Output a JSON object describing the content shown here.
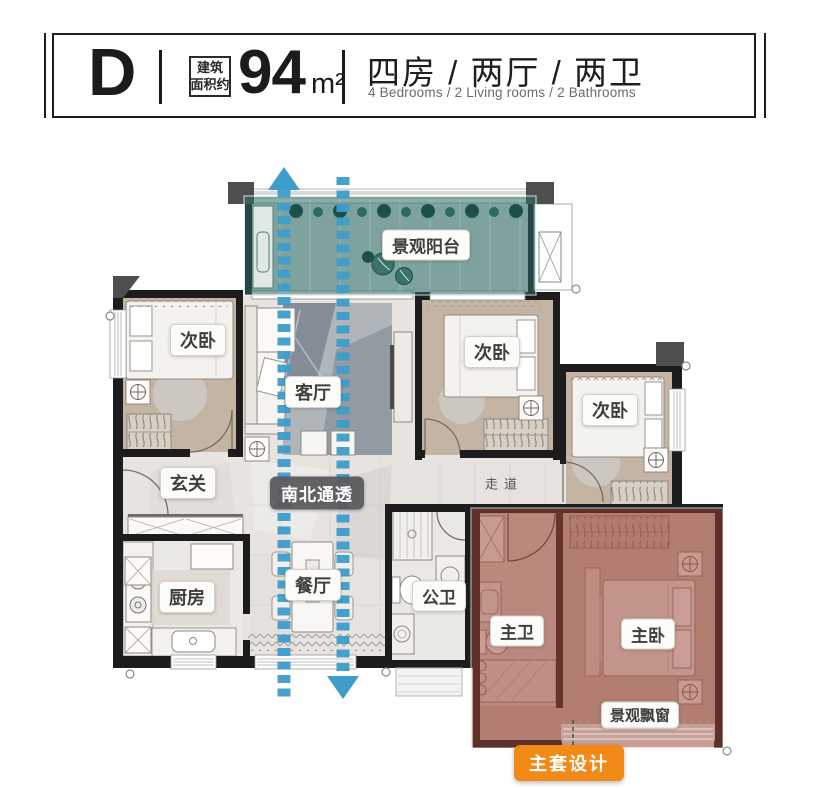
{
  "header": {
    "unit": "D",
    "area_label": [
      "建筑",
      "面积约"
    ],
    "area_value": "94",
    "area_unit": "m²",
    "layout_cn": "四房 / 两厅 / 两卫",
    "layout_en": "4 Bedrooms / 2 Living rooms / 2 Bathrooms"
  },
  "rooms": {
    "balcony": "景观阳台",
    "bedroom_left": "次卧",
    "living": "客厅",
    "bedroom_mid": "次卧",
    "bedroom_right": "次卧",
    "entry": "玄关",
    "corridor": "走道",
    "kitchen": "厨房",
    "dining": "餐厅",
    "public_bath": "公卫",
    "master_bath": "主卫",
    "master_bed": "主卧",
    "bay_window": "景观飘窗"
  },
  "badges": {
    "ventilation": "南北通透",
    "master_suite": "主套设计"
  },
  "colors": {
    "balcony_overlay": "#2f6d68",
    "suite_overlay": "#9b4335",
    "arrow_blue": "#3f9dcb",
    "suite_badge_orange": "#f28a17",
    "ventilation_badge_gray": "#59595c"
  }
}
